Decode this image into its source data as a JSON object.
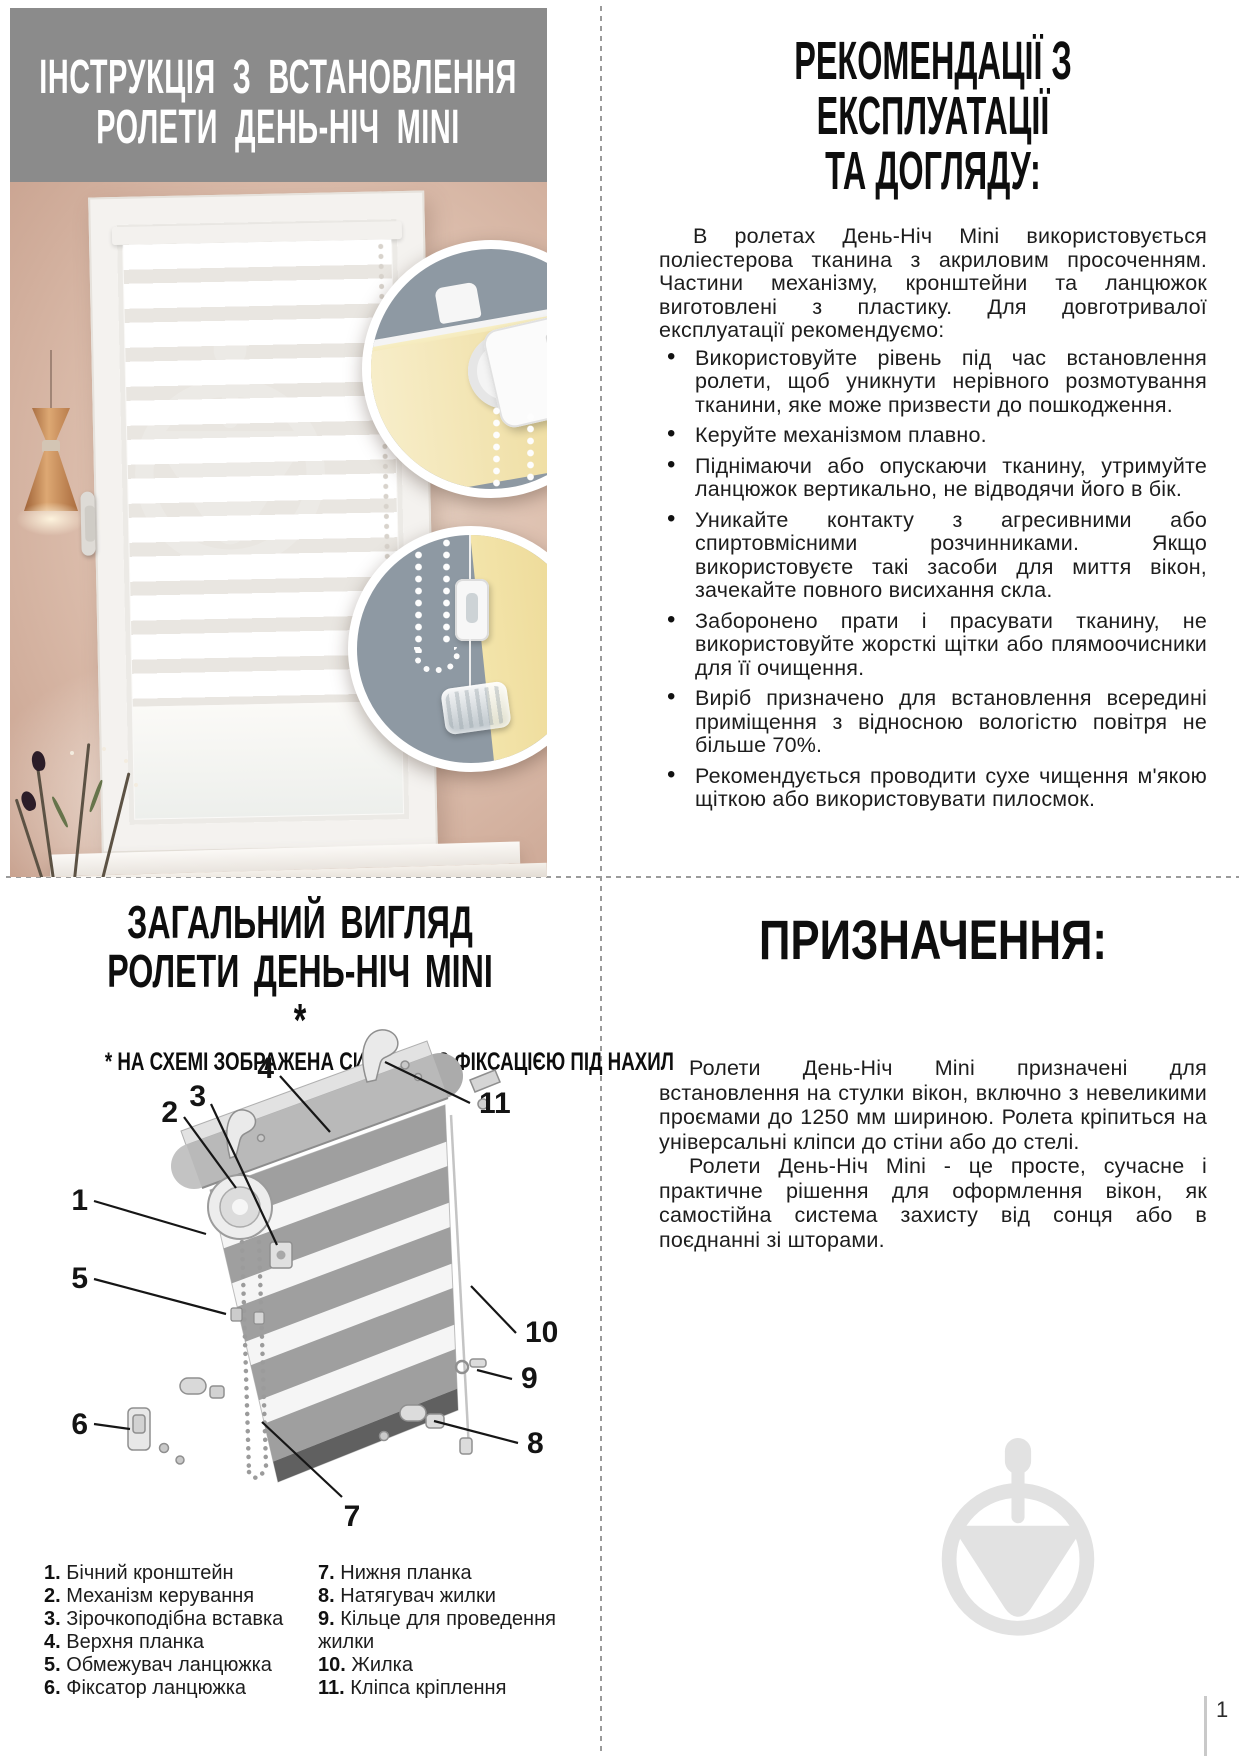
{
  "page": {
    "number": "1"
  },
  "colors": {
    "header_gray": "#8b8b8b",
    "text_black": "#111111",
    "wall_pink": "#ddbfae",
    "fabric_yellow": "#f3e2a4",
    "inset_slate": "#8e99a3",
    "watermark_gray": "#e2e2e2",
    "copper": "#c5814f"
  },
  "top_left": {
    "title_line1": "ІНСТРУКЦІЯ З ВСТАНОВЛЕННЯ",
    "title_line2": "РОЛЕТИ ДЕНЬ-НІЧ MINI"
  },
  "top_right": {
    "title_line1": "РЕКОМЕНДАЦІЇ З ЕКСПЛУАТАЦІЇ",
    "title_line2": "ТА ДОГЛЯДУ:",
    "intro": "В ролетах День-Ніч Mini використовується поліестерова тканина з акриловим просоченням. Частини механізму, кронштейни та ланцюжок виготовлені з пластику. Для довготривалої експлуатації рекомендуємо:",
    "bullets": [
      "Використовуйте рівень під час встановлення ролети, щоб уникнути нерівного розмотування тканини, яке може призвести до пошкодження.",
      "Керуйте механізмом плавно.",
      "Піднімаючи або опускаючи тканину, утримуйте ланцюжок вертикально, не відводячи його в бік.",
      "Уникайте контакту з агресивними або спиртовмісними розчинниками. Якщо використовуєте такі засоби для миття вікон, зачекайте повного висихання скла.",
      "Заборонено прати і прасувати тканину, не використовуйте жорсткі щітки або плямоочисники для її очищення.",
      "Виріб призначено для встановлення всередині приміщення з відносною вологістю повітря не більше 70%.",
      "Рекомендується проводити сухе чищення м'якою щіткою або використовувати пилосмок."
    ]
  },
  "bottom_left": {
    "title_line1": "ЗАГАЛЬНИЙ ВИГЛЯД",
    "title_line2": "РОЛЕТИ ДЕНЬ-НІЧ MINI *",
    "note": "* НА СХЕМІ ЗОБРАЖЕНА СИСТЕМА З ФІКСАЦІЄЮ ПІД НАХИЛ",
    "callouts": [
      "1",
      "2",
      "3",
      "4",
      "5",
      "6",
      "7",
      "8",
      "9",
      "10",
      "11"
    ],
    "legend_left": [
      {
        "num": "1.",
        "label": "Бічний кронштейн"
      },
      {
        "num": "2.",
        "label": "Механізм керування"
      },
      {
        "num": "3.",
        "label": "Зірочкоподібна вставка"
      },
      {
        "num": "4.",
        "label": "Верхня планка"
      },
      {
        "num": "5.",
        "label": "Обмежувач ланцюжка"
      },
      {
        "num": "6.",
        "label": "Фіксатор ланцюжка"
      }
    ],
    "legend_right": [
      {
        "num": "7.",
        "label": "Нижня планка"
      },
      {
        "num": "8.",
        "label": "Натягувач жилки"
      },
      {
        "num": "9.",
        "label": "Кільце для проведення жилки"
      },
      {
        "num": "10.",
        "label": "Жилка"
      },
      {
        "num": "11.",
        "label": "Кліпса кріплення"
      }
    ]
  },
  "bottom_right": {
    "title": "ПРИЗНАЧЕННЯ:",
    "para1": "Ролети День-Ніч Mini призначені для встановлення на стулки вікон, включно з невеликими проємами до 1250 мм шириною. Ролета кріпиться на універсальні кліпси до стіни або до стелі.",
    "para2": "Ролети День-Ніч Mini - це просте, сучасне і практичне рішення для оформлення вікон, як самостійна система захисту від сонця або в поєднанні зі шторами."
  }
}
